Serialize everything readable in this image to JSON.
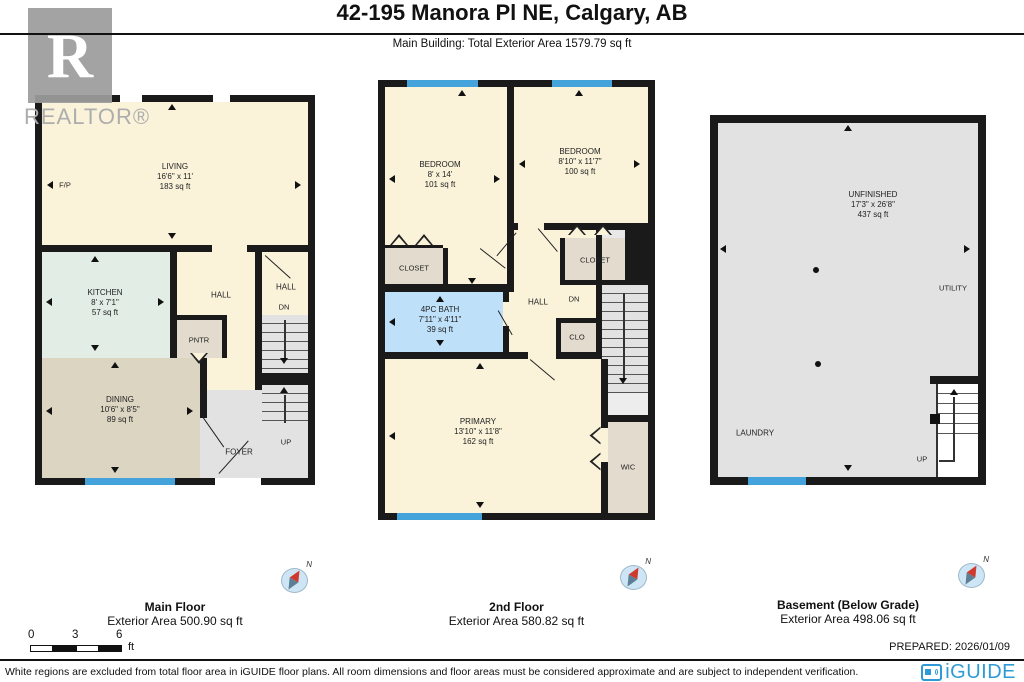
{
  "header": {
    "title": "42-195 Manora Pl NE, Calgary, AB",
    "subtitle": "Main Building: Total Exterior Area 1579.79 sq ft"
  },
  "branding": {
    "realtor_letter": "R",
    "realtor_text": "REALTOR®",
    "iguide_text": "iGUIDE",
    "prepared": "PREPARED: 2026/01/09"
  },
  "compass": {
    "label": "N"
  },
  "scale_bar": {
    "tick0": "0",
    "tick1": "3",
    "tick2": "6",
    "unit": "ft"
  },
  "disclaimer": "White regions are excluded from total floor area in iGUIDE floor plans. All room dimensions and floor areas must be considered approximate and are subject to independent verification.",
  "floors": {
    "main": {
      "caption": "Main Floor",
      "area_caption": "Exterior Area 500.90 sq ft",
      "living": {
        "name": "LIVING",
        "dims": "16'6\" x 11'",
        "area": "183 sq ft"
      },
      "kitchen": {
        "name": "KITCHEN",
        "dims": "8' x 7'1\"",
        "area": "57 sq ft"
      },
      "dining": {
        "name": "DINING",
        "dims": "10'6\" x 8'5\"",
        "area": "89 sq ft"
      },
      "hall1": "HALL",
      "hall2": "HALL",
      "pantry": "PNTR",
      "foyer": "FOYER",
      "fireplace": "F/P",
      "dn": "DN",
      "up": "UP"
    },
    "second": {
      "caption": "2nd Floor",
      "area_caption": "Exterior Area 580.82 sq ft",
      "bedroom1": {
        "name": "BEDROOM",
        "dims": "8' x 14'",
        "area": "101 sq ft"
      },
      "bedroom2": {
        "name": "BEDROOM",
        "dims": "8'10\" x 11'7\"",
        "area": "100 sq ft"
      },
      "bath": {
        "name": "4PC BATH",
        "dims": "7'11\" x 4'11\"",
        "area": "39 sq ft"
      },
      "primary": {
        "name": "PRIMARY",
        "dims": "13'10\" x 11'8\"",
        "area": "162 sq ft"
      },
      "closet1": "CLOSET",
      "closet2": "CLOSET",
      "clo": "CLO",
      "wic": "WIC",
      "hall": "HALL",
      "dn": "DN"
    },
    "basement": {
      "caption": "Basement (Below Grade)",
      "area_caption": "Exterior Area 498.06 sq ft",
      "unfinished": {
        "name": "UNFINISHED",
        "dims": "17'3\" x 26'8\"",
        "area": "437 sq ft"
      },
      "utility": "UTILITY",
      "laundry": "LAUNDRY",
      "up": "UP"
    }
  }
}
